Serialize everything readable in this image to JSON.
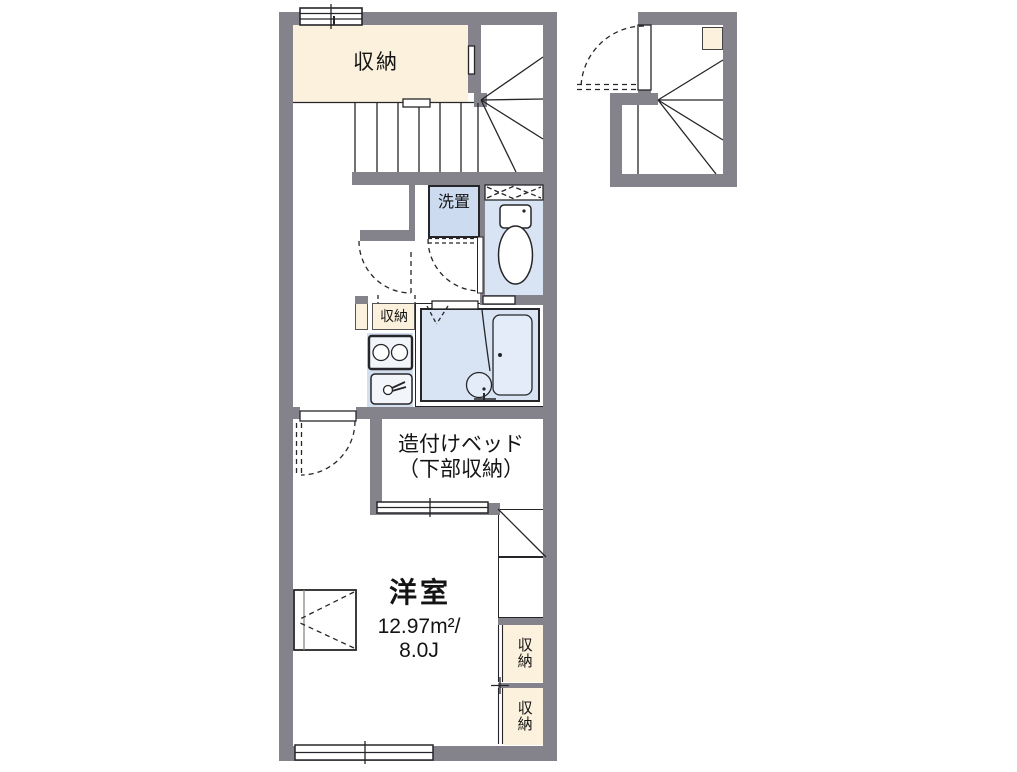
{
  "plan": {
    "labels": {
      "storage_top": "収納",
      "washer": "洗置",
      "storage_small": "収納",
      "bed_line1": "造付けベッド",
      "bed_line2": "（下部収納）",
      "room_name": "洋室",
      "room_area": "12.97m²/",
      "room_size": "8.0J",
      "closet_upper": "収納",
      "closet_lower": "収納"
    },
    "colors": {
      "wall": "#84838b",
      "cream": "#fbf1dc",
      "room_blue": "#d8e4f3",
      "washer_blue": "#ccdbef",
      "kitchen_blue": "#d3dfee",
      "line": "#26262a"
    }
  }
}
